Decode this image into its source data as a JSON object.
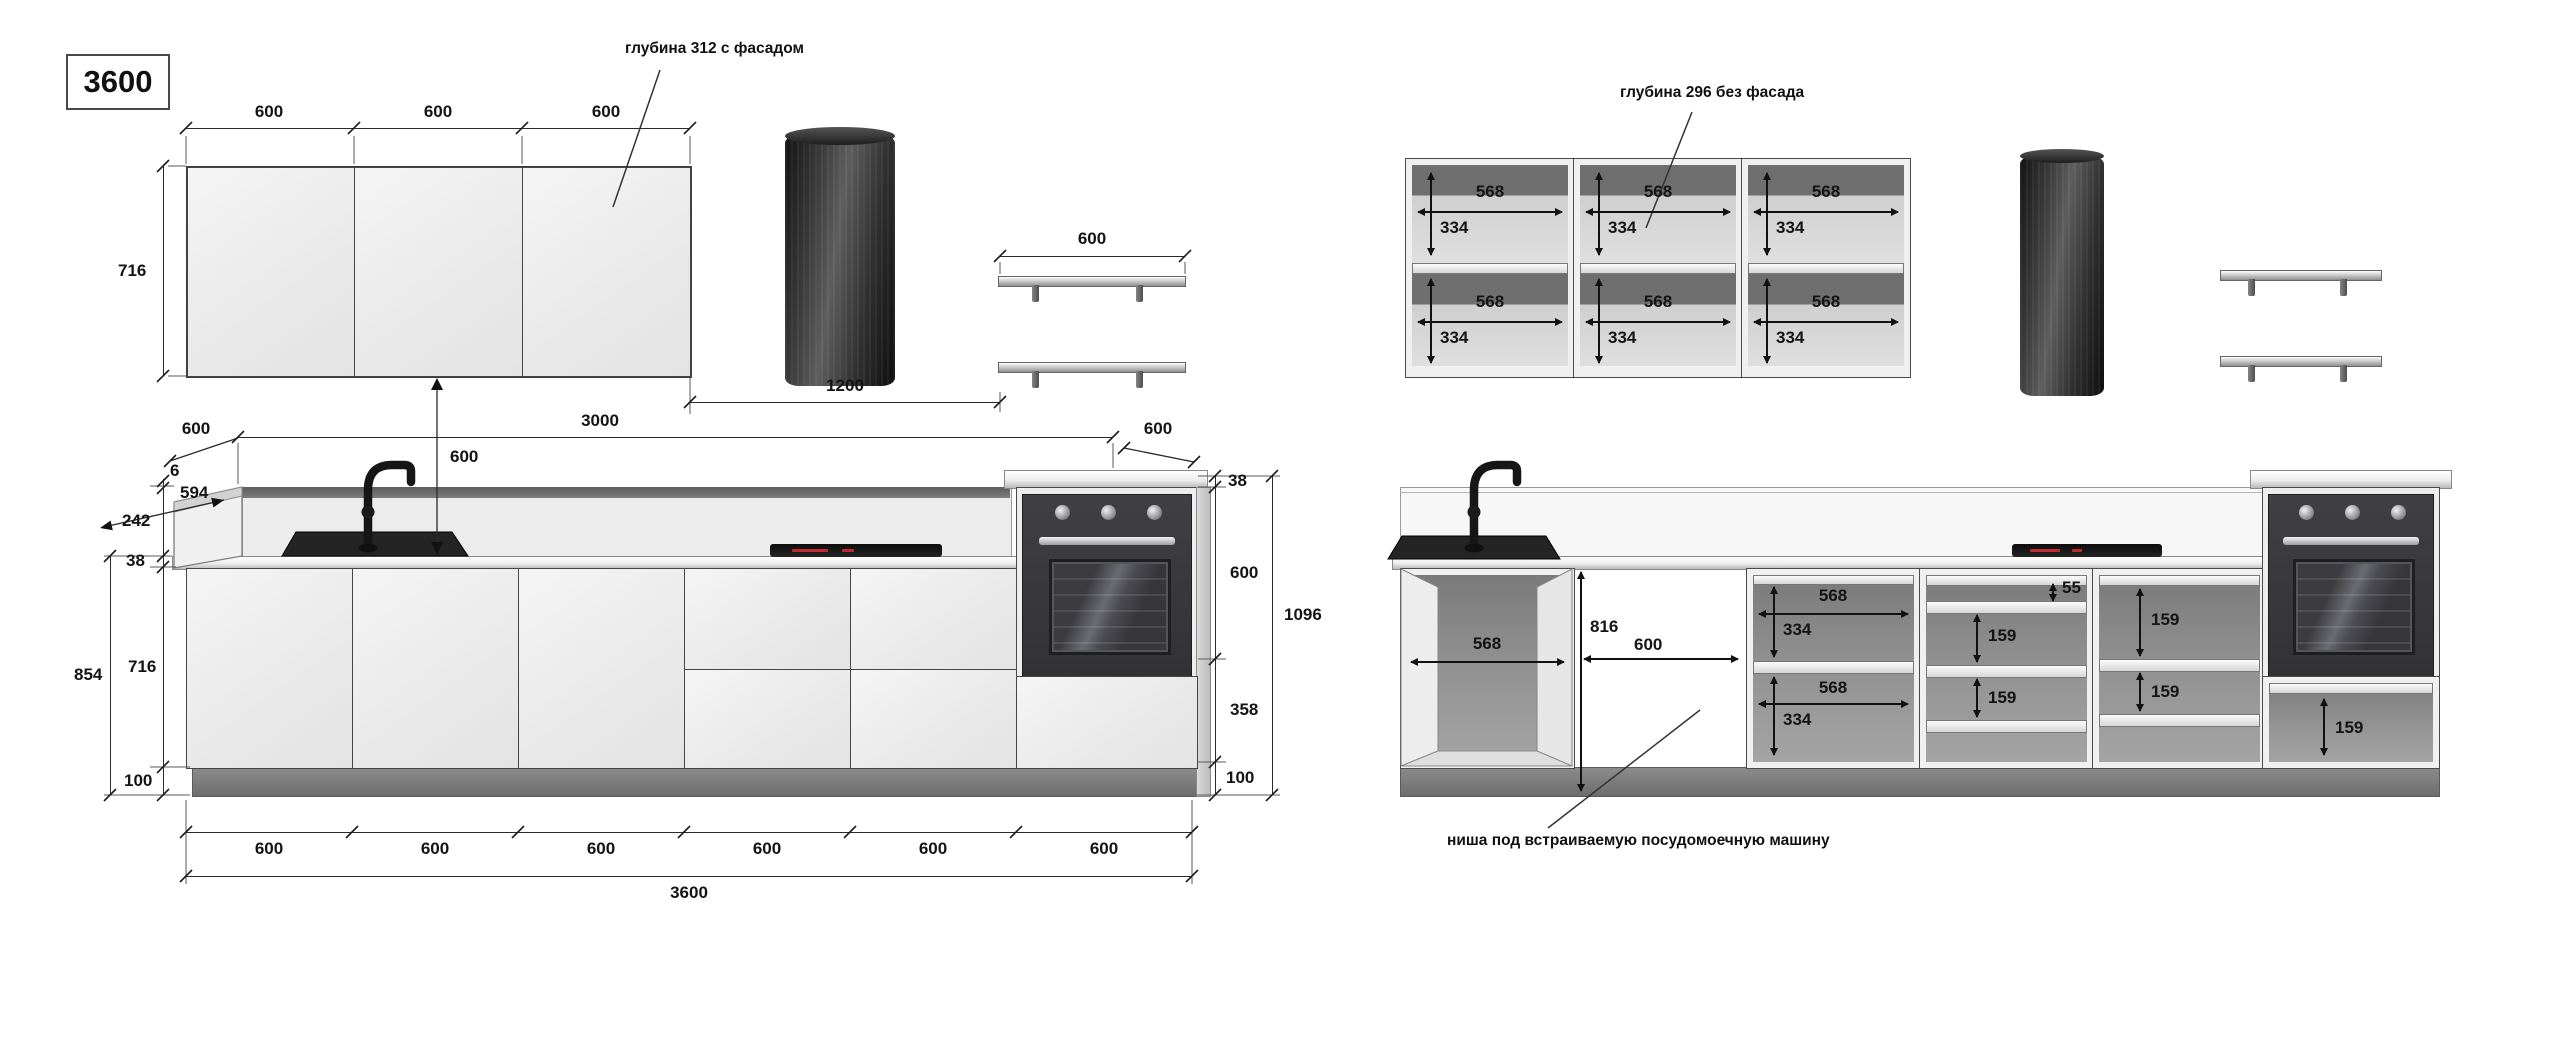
{
  "title": "3600",
  "ann": {
    "a1": "глубина 312 с фасадом",
    "a2": "глубина 296 без фасада",
    "a3": "ниша под встраиваемую посудомоечную машину"
  },
  "lv": {
    "top": [
      "600",
      "600",
      "600"
    ],
    "h716": "716",
    "shelf600": "600",
    "d1200": "1200",
    "dep600l": "600",
    "run3000": "3000",
    "dep600r": "600",
    "gap600": "600",
    "t6": "6",
    "d594": "594",
    "h242": "242",
    "t38": "38",
    "hdoor": "716",
    "h854": "854",
    "h100": "100",
    "tw38": "38",
    "tw600": "600",
    "tw358": "358",
    "tw100": "100",
    "tw1096": "1096",
    "bot": [
      "600",
      "600",
      "600",
      "600",
      "600",
      "600"
    ],
    "total": "3600"
  },
  "rv": {
    "u": [
      {
        "w1": "568",
        "h1": "334",
        "w2": "568",
        "h2": "334"
      },
      {
        "w1": "568",
        "h1": "334",
        "w2": "568",
        "h2": "334"
      },
      {
        "w1": "568",
        "h1": "334",
        "w2": "568",
        "h2": "334"
      }
    ],
    "sink568": "568",
    "n816": "816",
    "n600": "600",
    "s": {
      "w1": "568",
      "h1": "334",
      "w2": "568",
      "h2": "334"
    },
    "d1": {
      "a": "55",
      "b": "159",
      "c": "159"
    },
    "d2": {
      "a": "159",
      "b": "159"
    },
    "tow159": "159"
  }
}
